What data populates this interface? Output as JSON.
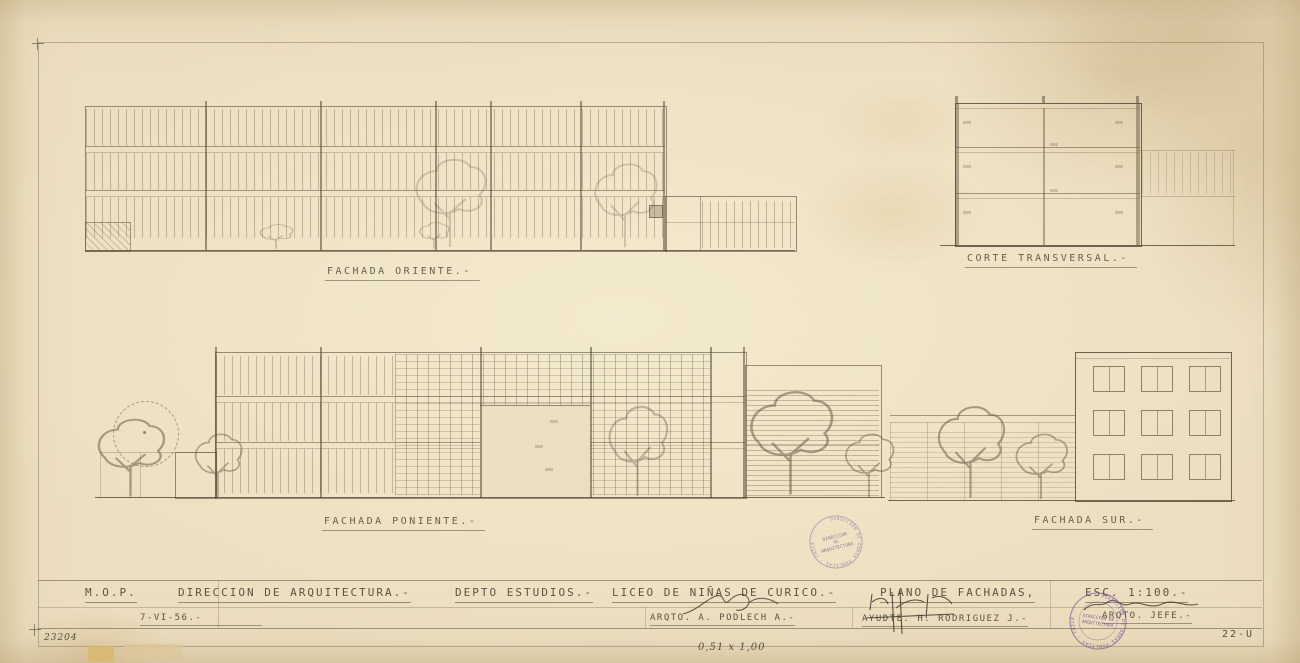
{
  "drawings": {
    "oriente_label": "FACHADA ORIENTE.-",
    "corte_label": "CORTE TRANSVERSAL.-",
    "poniente_label": "FACHADA PONIENTE.-",
    "sur_label": "FACHADA SUR.-"
  },
  "title_block": {
    "org": "M.O.P.",
    "direction": "DIRECCION DE ARQUITECTURA.-",
    "department": "DEPTO ESTUDIOS.-",
    "project": "LICEO DE NIÑAS DE CURICO.-",
    "plan_title": "PLANO DE FACHADAS,",
    "scale": "ESC. 1:100.-",
    "date": "7-VI-56.-",
    "architect": "ARQTO. A. PODLECH A.-",
    "assistant": "AYUDTE. H. RODRIGUEZ J.-",
    "chief": "ARQTO. JEFE.-"
  },
  "margin_notes": {
    "register_number": "23204",
    "sheet_size_note": "0,51 x 1,00",
    "sheet_code": "22-U"
  },
  "stamps": {
    "center": {
      "ring_text": "DIRECCION DE OBRAS PUBLICAS · CHILE ·",
      "line1": "DIRECCION",
      "line2": "DE",
      "line3": "ARQUITECTURA"
    },
    "corner": {
      "ring_text": "DIRECCION DE OBRAS PUBLICAS · CHILE ·",
      "line1": "DIRECCION DE",
      "line2": "ARQUITECTURA"
    }
  },
  "colors": {
    "paper": "#ecdfc0",
    "pencil": "#6e6450",
    "stamp_purple": "#7c5a96"
  }
}
